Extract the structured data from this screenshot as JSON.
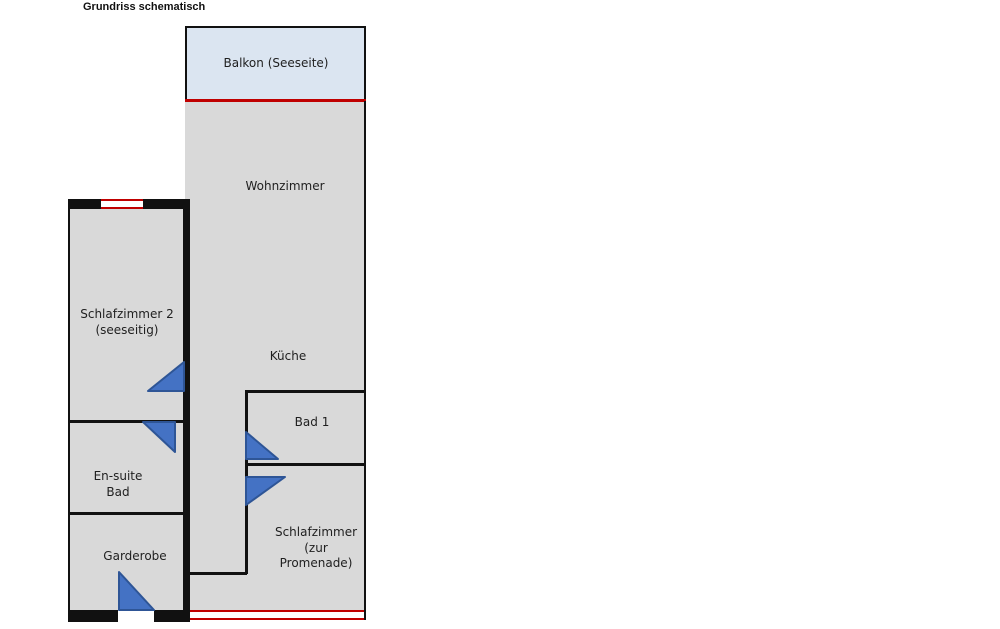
{
  "title": "Grundriss schematisch",
  "plan": {
    "rooms": {
      "balkon": {
        "label": "Balkon (Seeseite)"
      },
      "wohnzimmer": {
        "label": "Wohnzimmer"
      },
      "kueche": {
        "label": "Küche"
      },
      "schlafzimmer2": {
        "line1": "Schlafzimmer 2",
        "line2": "(seeseitig)"
      },
      "ensuite_bad": {
        "line1": "En-suite",
        "line2": "Bad"
      },
      "garderobe": {
        "label": "Garderobe"
      },
      "bad1": {
        "label": "Bad 1"
      },
      "schlafzimmer_promenade": {
        "line1": "Schlafzimmer",
        "line2": "(zur",
        "line3": "Promenade)"
      }
    },
    "icons": {
      "door_swing": "blue right-triangle door swing",
      "window": "red double line window"
    },
    "colors": {
      "room_fill": "#d9d9d9",
      "balcony_fill": "#dbe5f1",
      "wall": "#111111",
      "window_red": "#c00000",
      "door_fill": "#4472c4",
      "door_border": "#2e5596",
      "text": "#1f1f1f",
      "background": "#ffffff"
    }
  }
}
